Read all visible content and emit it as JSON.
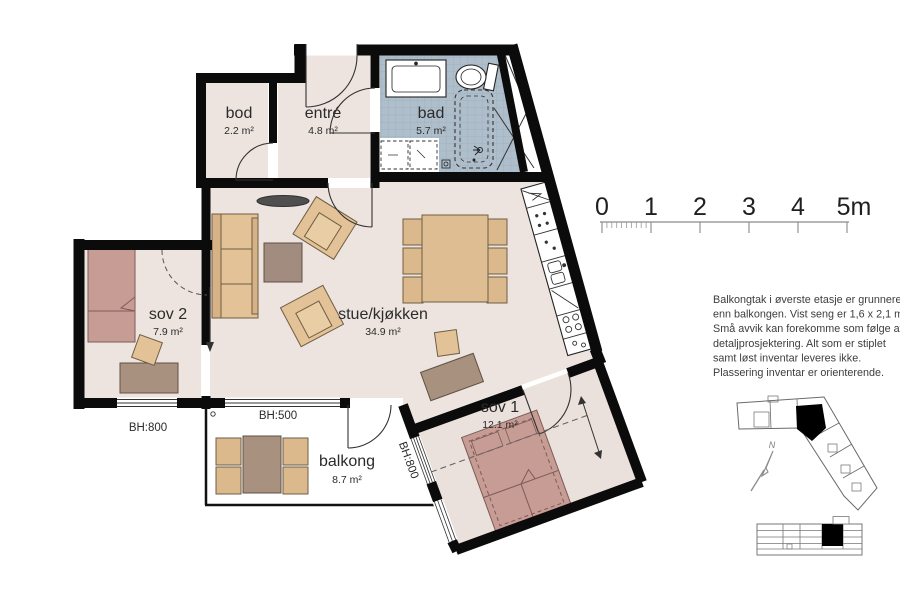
{
  "plan": {
    "rooms": [
      {
        "id": "bod",
        "name": "bod",
        "area": "2.2 m²"
      },
      {
        "id": "entre",
        "name": "entré",
        "area": "4.8 m²"
      },
      {
        "id": "bad",
        "name": "bad",
        "area": "5.7 m²"
      },
      {
        "id": "sov2",
        "name": "sov 2",
        "area": "7.9 m²"
      },
      {
        "id": "stue",
        "name": "stue/kjøkken",
        "area": "34.9 m²"
      },
      {
        "id": "sov1",
        "name": "sov 1",
        "area": "12.1 m²"
      },
      {
        "id": "balkong",
        "name": "balkong",
        "area": "8.7 m²"
      }
    ],
    "sills": {
      "sov2_window": "BH:800",
      "balkong_window": "BH:500",
      "sov1_balkong_window": "BH:800"
    }
  },
  "scale_bar": {
    "ticks": [
      "0",
      "1",
      "2",
      "3",
      "4",
      "5m"
    ]
  },
  "notes": {
    "lines": [
      "Balkongtak i øverste etasje er grunnere",
      "enn balkongen. Vist seng er 1,6 x 2,1 m.",
      "Små avvik kan forekomme som følge av",
      "detaljprosjektering. Alt som er stiplet",
      "samt løst inventar leveres ikke.",
      "Plassering inventar er orienterende."
    ]
  },
  "compass": {
    "north_label": "N"
  },
  "colors": {
    "wall": "#0b0b0b",
    "floor": "#EDE4DF",
    "bedroom1_floor": "#EBE1DC",
    "bathroom_tile": "#AFBECB",
    "furniture_tan": "#E2C296",
    "furniture_brown": "#A8917F",
    "bed_pink": "#C79C95",
    "balcony_floor": "#FFFFFF"
  }
}
